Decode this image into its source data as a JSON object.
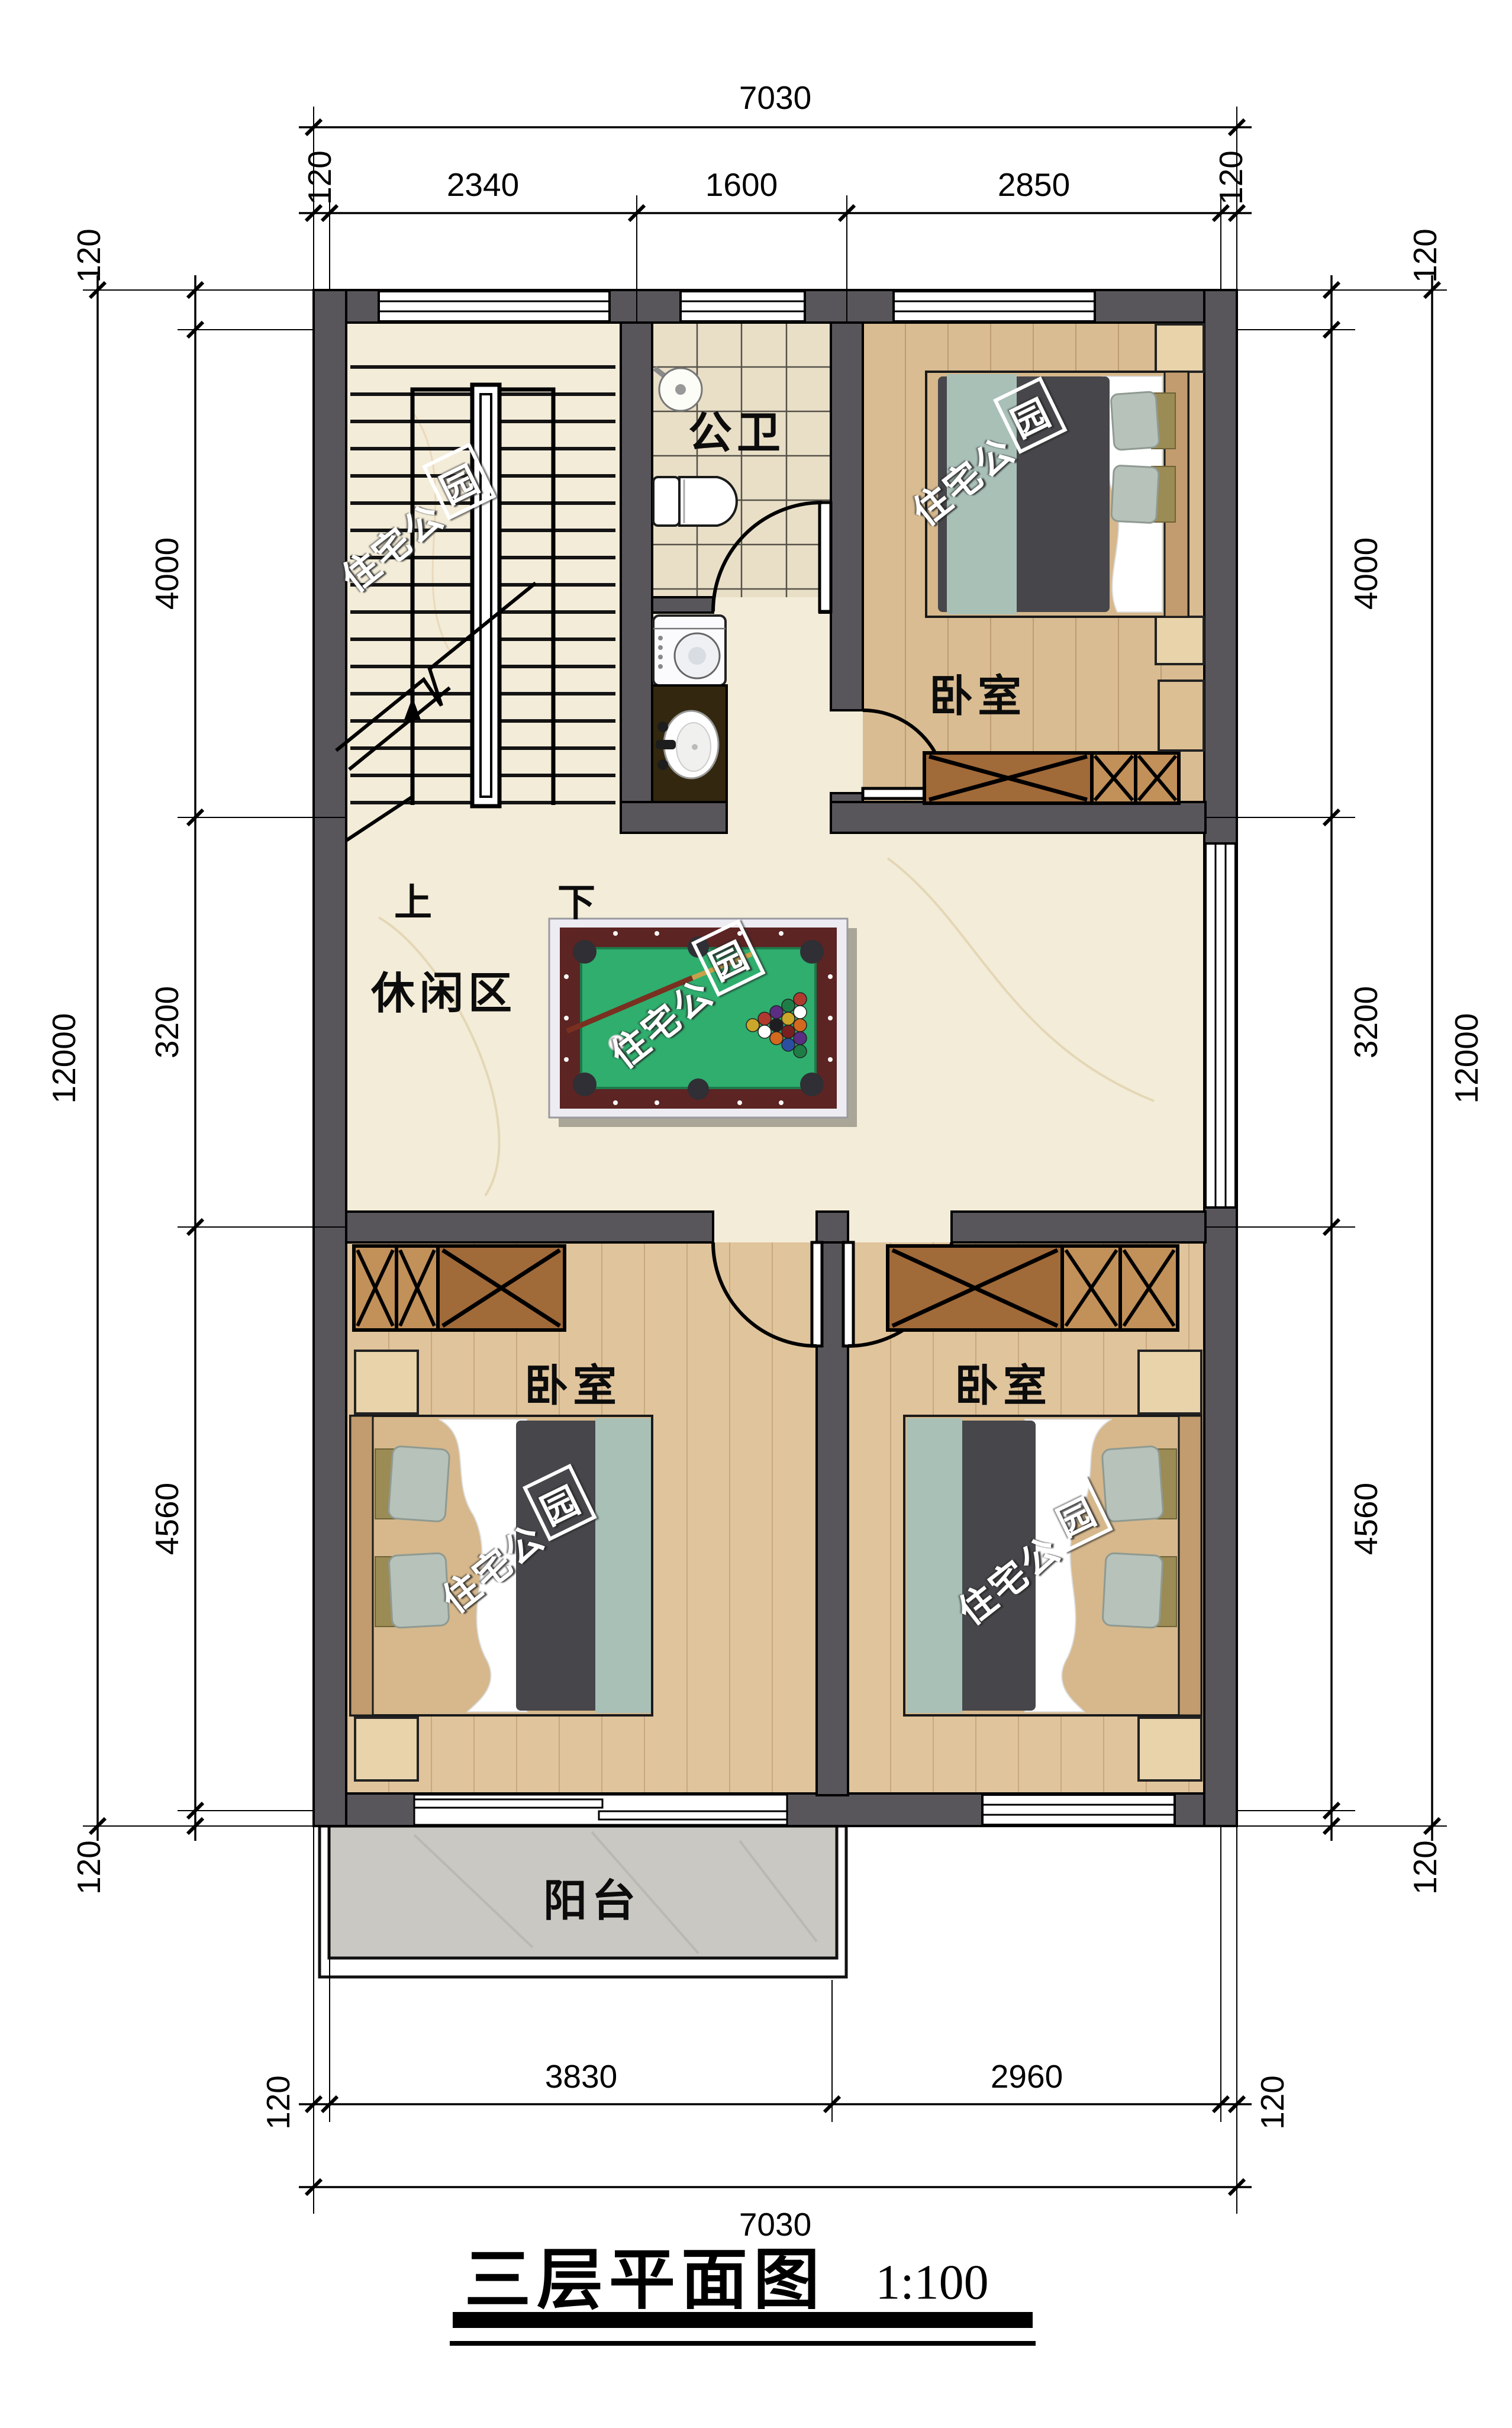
{
  "title": {
    "name": "三层平面图",
    "scale": "1:100"
  },
  "rooms": {
    "bathroom": "公卫",
    "bedroom_top_right": "卧室",
    "leisure": "休闲区",
    "bedroom_bottom_left": "卧室",
    "bedroom_bottom_right": "卧室",
    "balcony": "阳台"
  },
  "stairs": {
    "up": "上",
    "down": "下"
  },
  "watermark": {
    "part1": "住宅公",
    "part2": "园"
  },
  "dimensions": {
    "top": {
      "total": "7030",
      "seg0": "120",
      "seg1": "2340",
      "seg2": "1600",
      "seg3": "2850",
      "seg4": "120"
    },
    "bottom": {
      "total": "7030",
      "seg0": "120",
      "seg1": "3830",
      "seg2": "2960",
      "seg3": "120"
    },
    "left": {
      "total": "12000",
      "seg0": "120",
      "seg1": "4000",
      "seg2": "3200",
      "seg3": "4560",
      "seg4": "120"
    },
    "right": {
      "total": "12000",
      "seg0": "120",
      "seg1": "4000",
      "seg2": "3200",
      "seg3": "4560",
      "seg4": "120"
    }
  },
  "colors": {
    "wall": "#59565b",
    "floor_marble": "#f3ecd8",
    "floor_tile": "#e9dfc7",
    "floor_wood": "#d9bc92",
    "wardrobe_wood": "#a16a39",
    "pool_felt": "#2fae6e",
    "pool_rail": "#5c2422",
    "balcony_floor": "#c9c8c3",
    "duvet": "#46464b",
    "blanket": "#a9c0b7"
  }
}
